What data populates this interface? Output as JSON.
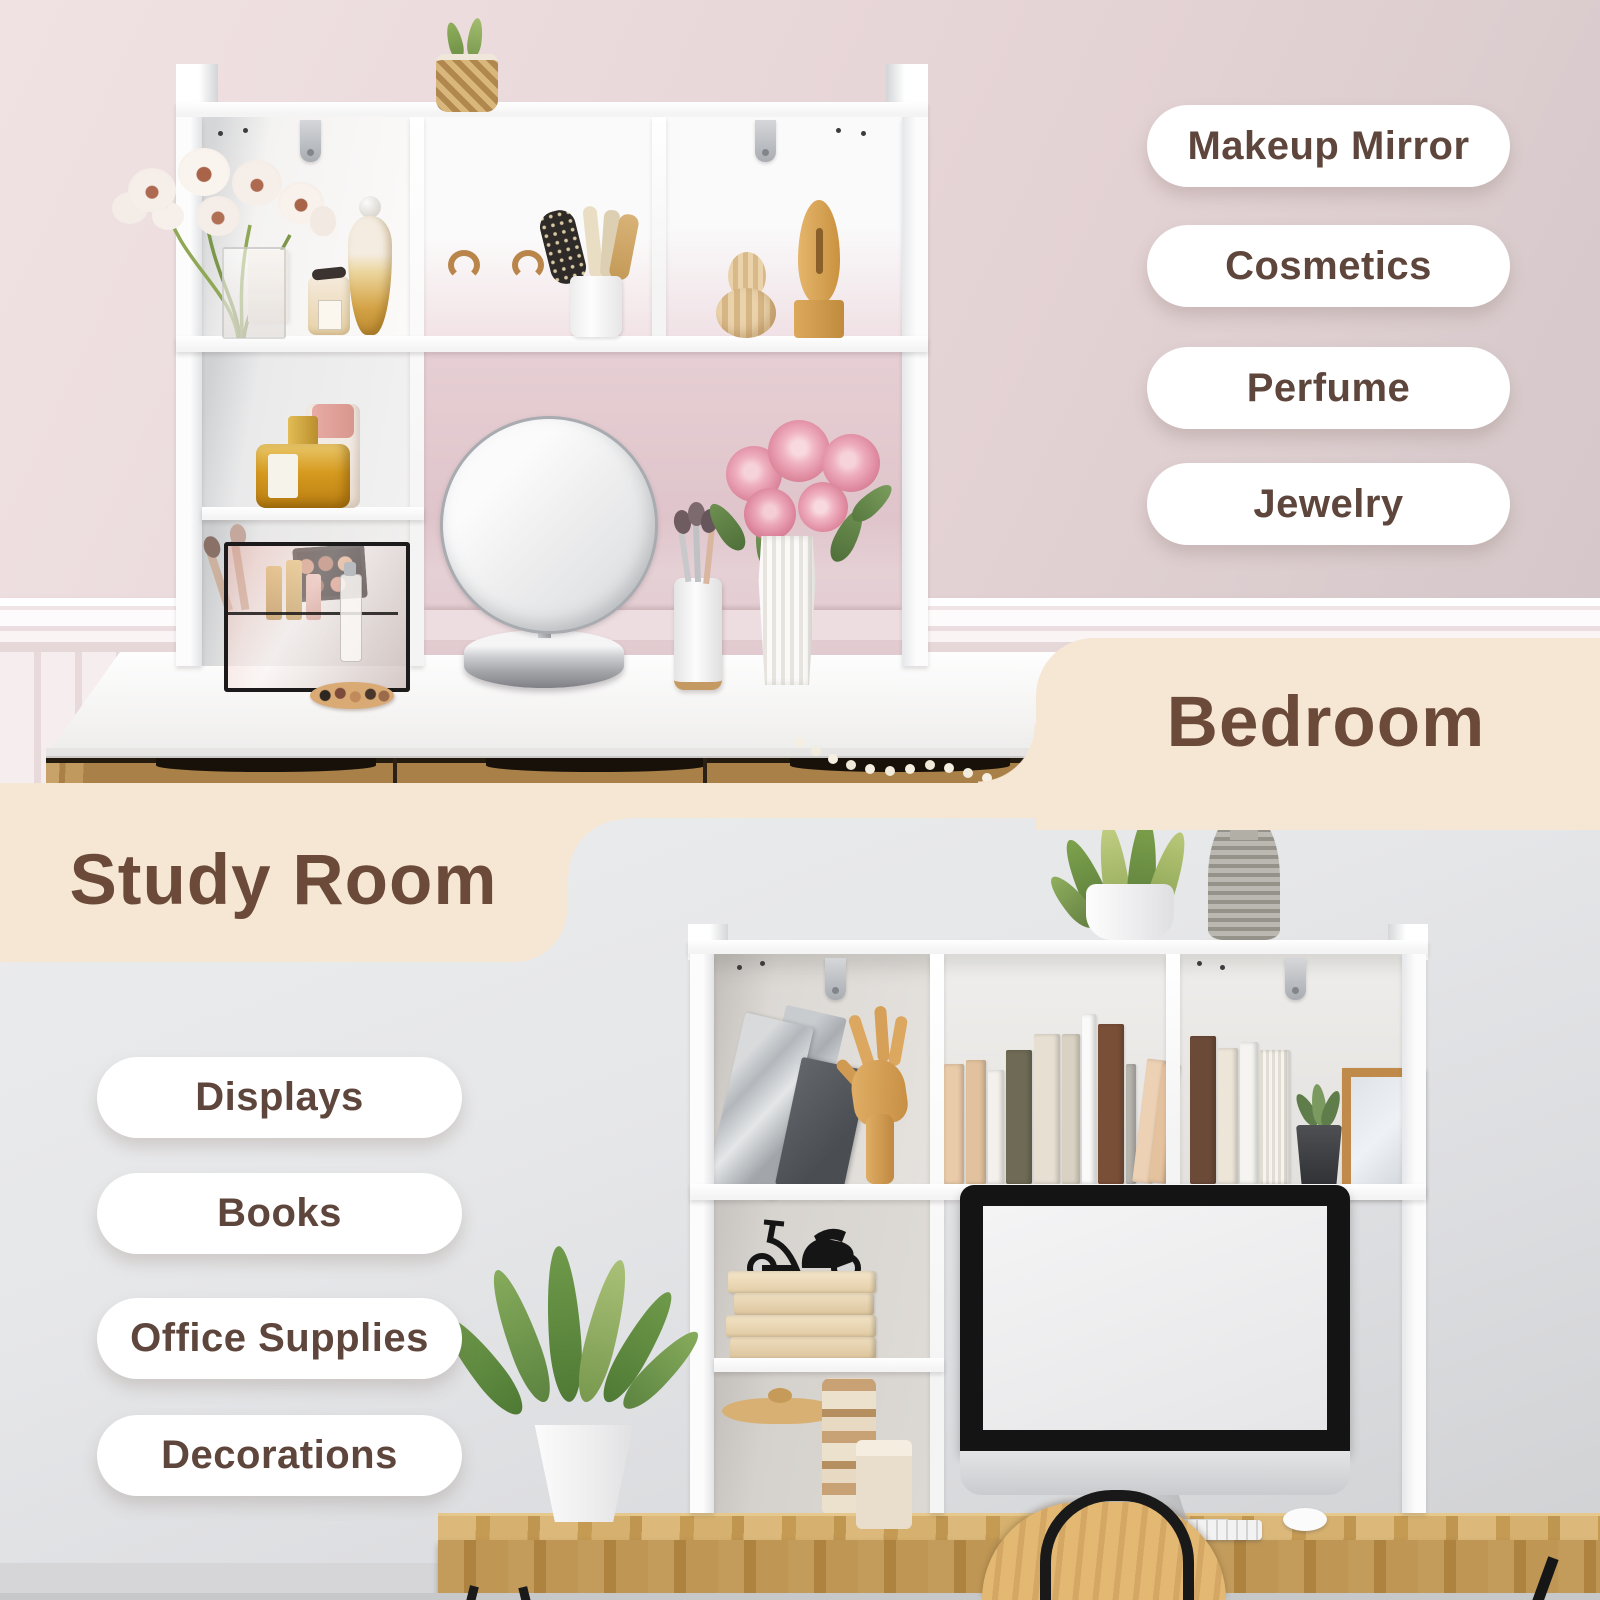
{
  "bedroom": {
    "title": "Bedroom",
    "pills": [
      "Makeup Mirror",
      "Cosmetics",
      "Perfume",
      "Jewelry"
    ]
  },
  "study": {
    "title": "Study Room",
    "pills": [
      "Displays",
      "Books",
      "Office Supplies",
      "Decorations"
    ]
  },
  "colors": {
    "cream": "#f6e7d5",
    "heading_brown": "#6c4a3a",
    "pill_text_brown": "#5e463c",
    "pill_background": "#ffffff",
    "bedroom_wall_pink": "#e8d6d8",
    "bedroom_niche_pink": "#dfc5cb",
    "study_wall_gray": "#e4e5e7",
    "desk_wood": "#c6994f",
    "organizer_white": "#fdfdfd"
  }
}
